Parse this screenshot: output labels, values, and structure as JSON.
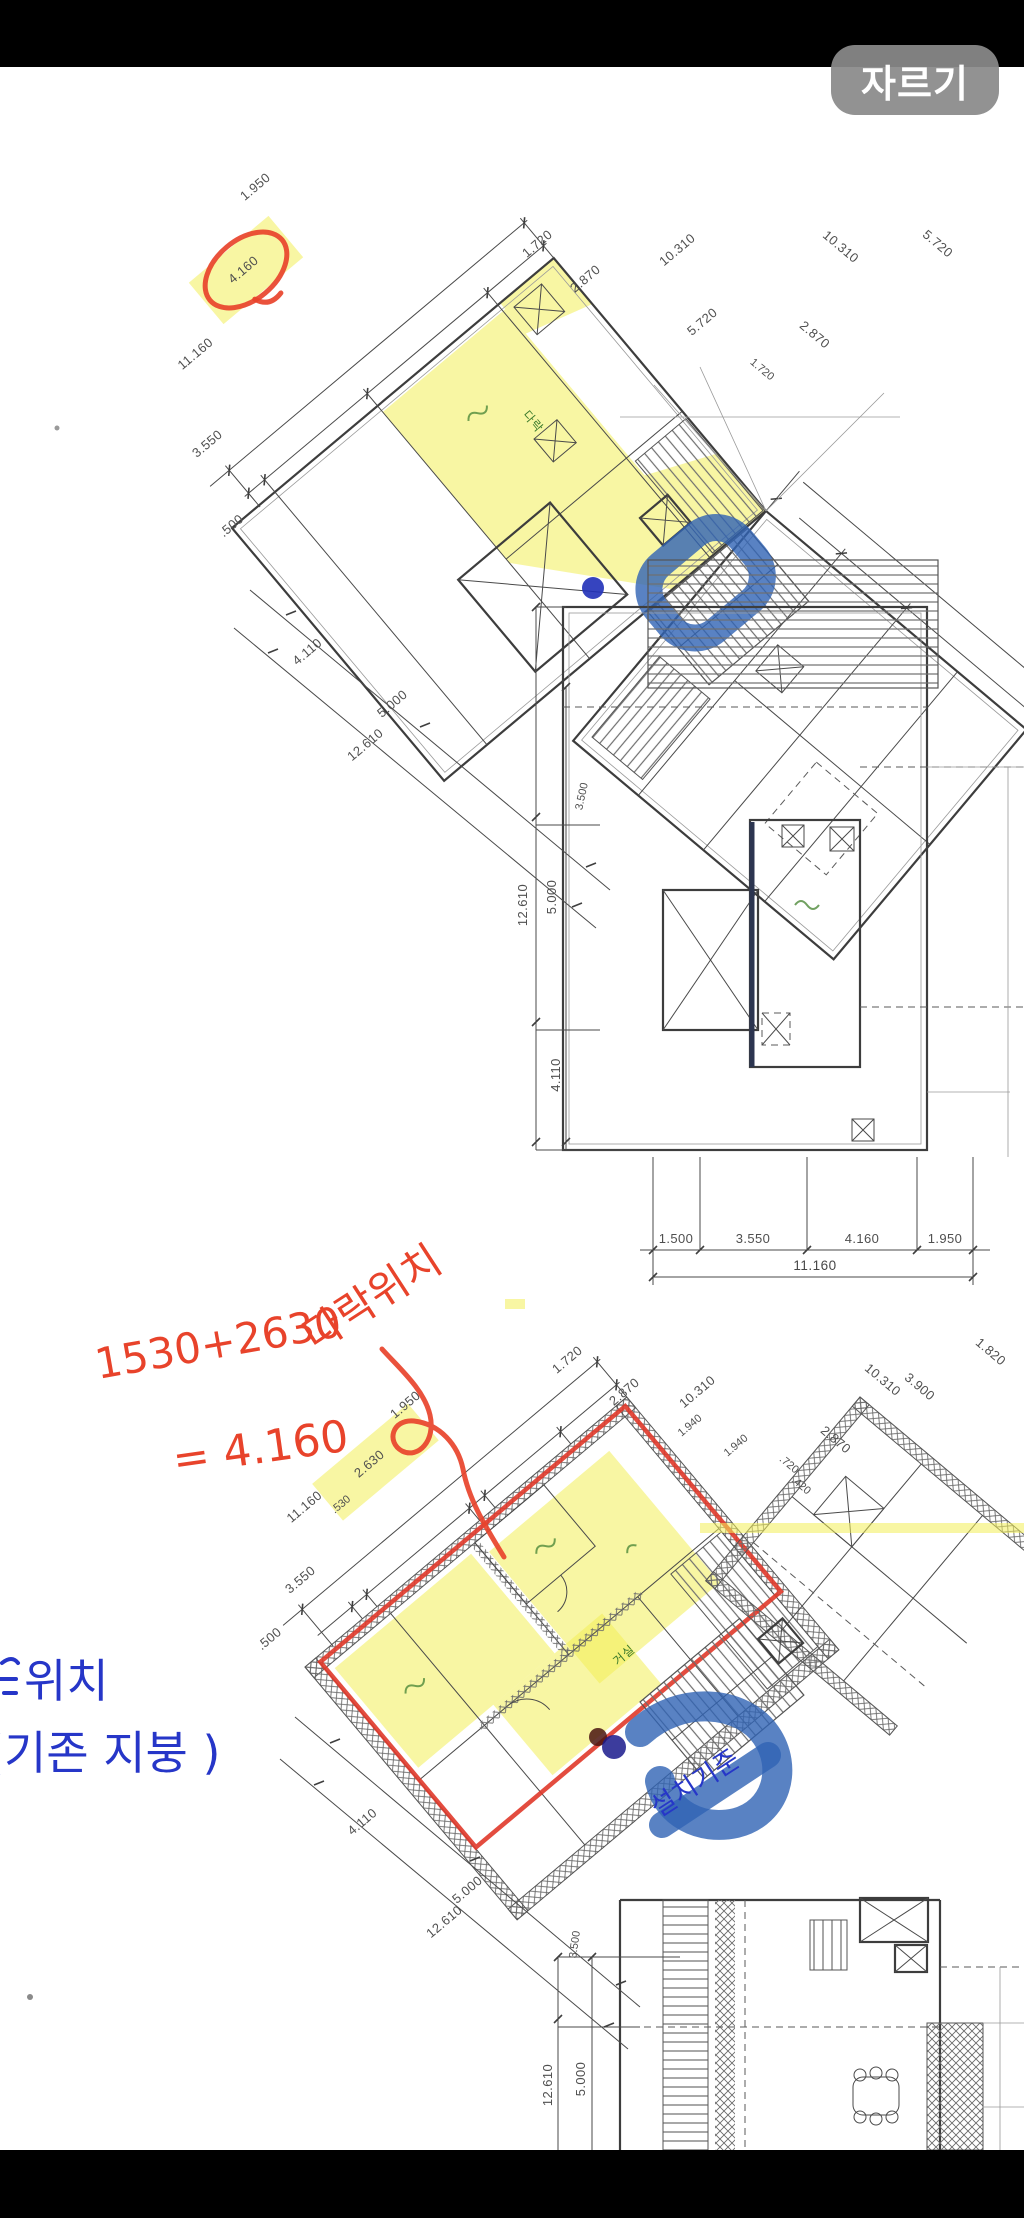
{
  "toolbar": {
    "crop_label": "자르기"
  },
  "colors": {
    "paper": "#ffffff",
    "frame_black": "#000000",
    "button_gray": "#8a8a8a",
    "plan_line": "#4a4a4a",
    "highlight_yellow": "#f3ee58",
    "marker_blue": "#2f63b4",
    "pen_blue": "#2636c8",
    "pen_red": "#e8432b",
    "room_green": "#3c7b2c"
  },
  "top_plan": {
    "edge_dims": [
      "1.950",
      "4.160",
      "11.160",
      "3.550",
      ".500"
    ],
    "top_dims": [
      "1.720",
      "2.870",
      "10.310",
      "10.310",
      "5.720",
      "5.720",
      "1.720",
      "2.870"
    ],
    "center_dims": [
      "12.610",
      "5.000",
      "4.110",
      "3.500"
    ],
    "diag_dims": [
      "4.110",
      "5.000",
      "12.610"
    ],
    "bottom_dims": [
      "1.500",
      "3.550",
      "4.160",
      "1.950"
    ],
    "bottom_total": "11.160",
    "room_label": "다락"
  },
  "bottom_plan": {
    "edge_dims": [
      "1.950",
      "2.630",
      ".530",
      "11.160",
      "3.550",
      ".500"
    ],
    "top_dims_left": [
      "1.720",
      "2.870",
      "10.310",
      "1.940",
      "1.940"
    ],
    "top_dims_right": [
      ".720",
      ".420",
      "2.870",
      "10.310",
      "3.900",
      "1.820"
    ],
    "diag_dims": [
      "4.110",
      "5.000",
      "12.610"
    ],
    "vert_dims": [
      "3.500",
      "12.610",
      "5.000"
    ],
    "room_label": "거실"
  },
  "annotations": {
    "red_title": "다락위치",
    "red_calc": "1530+2630",
    "red_result": "= 4.160",
    "blue_note_line1": "위치",
    "blue_note_line2": "(기존 지붕 )",
    "blue_stair_note": "설치기준"
  }
}
